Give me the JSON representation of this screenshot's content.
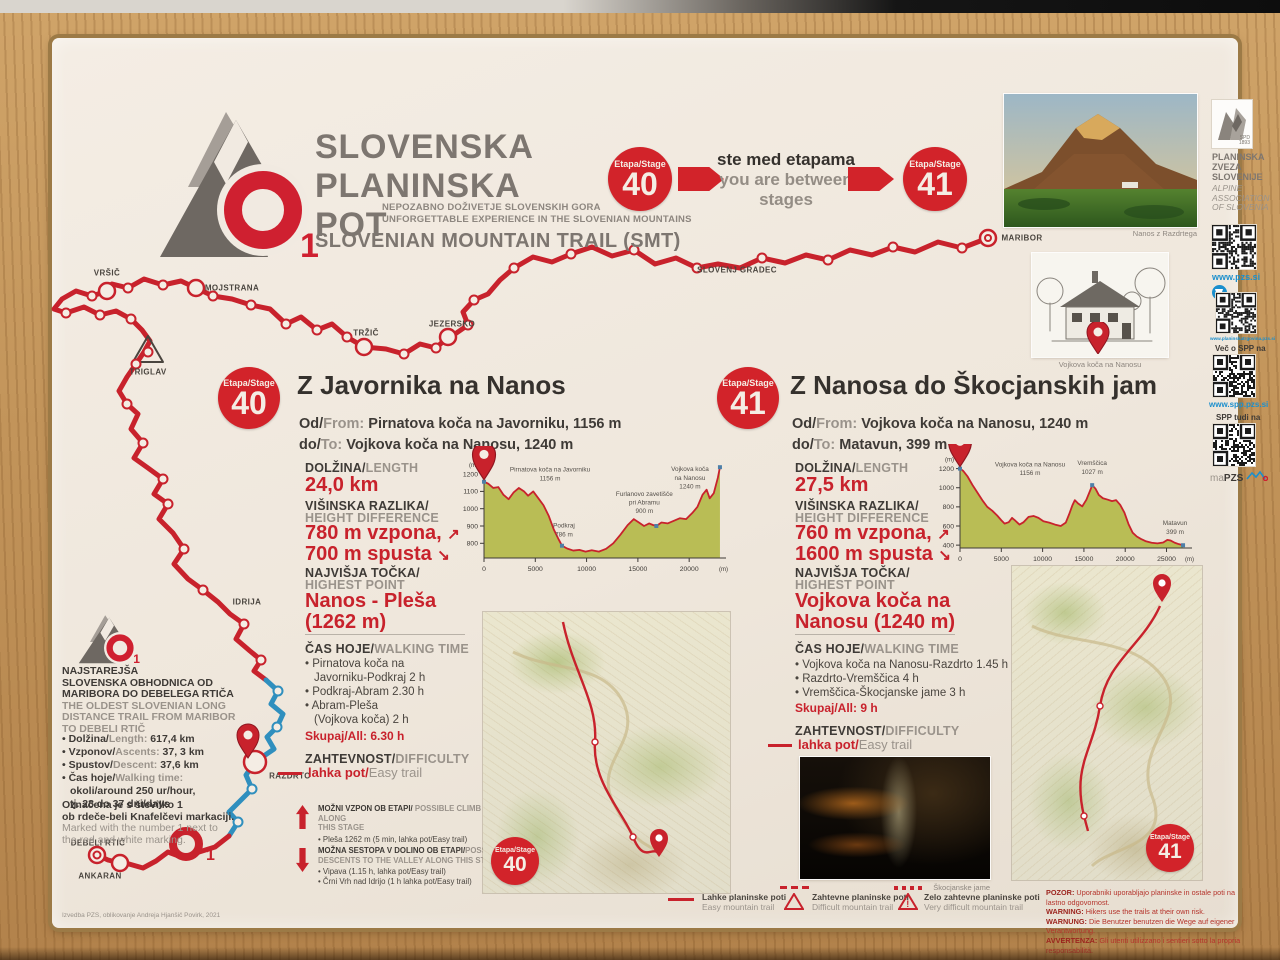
{
  "header": {
    "title_l1": "SLOVENSKA",
    "title_l2": "PLANINSKA",
    "title_l3": "POT",
    "logo_number": "1",
    "sub_sl": "NEPOZABNO DOŽIVETJE SLOVENSKIH GORA",
    "sub_en": "UNFORGETTABLE EXPERIENCE IN THE SLOVENIAN MOUNTAINS",
    "trail_en": "SLOVENIAN MOUNTAIN TRAIL (SMT)",
    "stage_label": "Etapa/Stage",
    "stage_left_num": "40",
    "stage_right_num": "41",
    "between_sl": "ste med etapama",
    "between_en": "you are between stages",
    "photo_caption": "Nanos z Razdrtega",
    "pzs_l1": "PLANINSKA",
    "pzs_l2": "ZVEZA",
    "pzs_l3": "SLOVENIJE",
    "pzs_en_l1": "ALPINE",
    "pzs_en_l2": "ASSOCIATION",
    "pzs_en_l3": "OF SLOVENIA",
    "spd": "SPD",
    "spd_year": "1893"
  },
  "sidebar": {
    "url_pzs": "www.pzs.si",
    "url_shop": "www.planinskatrgovina.pzs.si",
    "more_label": "Več o SPP na",
    "url_spp": "www.spp.pzs.si",
    "also_label": "SPP tudi na",
    "mapzs_ma": "ma",
    "mapzs_pzs": "PZS"
  },
  "map_labels": {
    "vrsic": "VRŠIČ",
    "mojstrana": "MOJSTRANA",
    "triglav": "TRIGLAV",
    "trzic": "TRŽIČ",
    "jezersko": "JEZERSKO",
    "slovenj_gradec": "SLOVENJ GRADEC",
    "maribor": "MARIBOR",
    "idrija": "IDRIJA",
    "razdrto": "RAZDRTO",
    "debeli_rtic": "DEBELI RTIČ",
    "ankaran": "ANKARAN"
  },
  "stage40": {
    "badge_label": "Etapa/Stage",
    "badge_num": "40",
    "title": "Z Javornika na Nanos",
    "od_sl": "Od/",
    "od_en": "From:",
    "od_val": " Pirnatova koča na Javorniku, 1156 m",
    "do_sl": "do/",
    "do_en": "To:",
    "do_val": " Vojkova koča na Nanosu, 1240 m",
    "len_sl": "DOLŽINA/",
    "len_en": "LENGTH",
    "len_val": "24,0 km",
    "hd_sl": "VIŠINSKA RAZLIKA/",
    "hd_en": "HEIGHT DIFFERENCE",
    "hd_up": "780 m vzpona,",
    "hd_down": "700 m spusta",
    "hp_sl": "NAJVIŠJA TOČKA/",
    "hp_en": "HIGHEST POINT",
    "hp_val1": "Nanos - Pleša",
    "hp_val2": "(1262 m)",
    "time_sl": "ČAS HOJE/",
    "time_en": "WALKING TIME",
    "time_lines": [
      "• Pirnatova koča na",
      "Javorniku-Podkraj 2 h",
      "• Podkraj-Abram 2.30 h",
      "• Abram-Pleša",
      "(Vojkova koča) 2 h"
    ],
    "time_total_label": "Skupaj/All:",
    "time_total": " 6.30 h",
    "diff_sl": "ZAHTEVNOST/",
    "diff_en": "DIFFICULTY",
    "diff_val_sl": "lahka pot/",
    "diff_val_en": "Easy trail",
    "climb_sl": "MOŽNI VZPON OB ETAPI/",
    "climb_en": " POSSIBLE CLIMB ALONG",
    "climb_en2": "THIS STAGE",
    "climb_item": "•  Pleša 1262 m (5 min, lahka pot/Easy trail)",
    "desc_sl": "MOŽNA SESTOPA V DOLINO OB ETAPI/",
    "desc_en": "POSSIBLE",
    "desc_en2": "DESCENTS TO THE VALLEY ALONG THIS STAGE",
    "desc_items": [
      "•  Vipava (1.15 h, lahka pot/Easy trail)",
      "•  Črni Vrh nad Idrijo (1 h lahka pot/Easy trail)"
    ]
  },
  "stage41": {
    "badge_label": "Etapa/Stage",
    "badge_num": "41",
    "title": "Z Nanosa do Škocjanskih jam",
    "od_sl": "Od/",
    "od_en": "From:",
    "od_val": " Vojkova koča na Nanosu, 1240 m",
    "do_sl": "do/",
    "do_en": "To:",
    "do_val": " Matavun, 399 m",
    "len_sl": "DOLŽINA/",
    "len_en": "LENGTH",
    "len_val": "27,5 km",
    "hd_sl": "VIŠINSKA RAZLIKA/",
    "hd_en": "HEIGHT DIFFERENCE",
    "hd_up": "760 m vzpona,",
    "hd_down": "1600 m spusta",
    "hp_sl": "NAJVIŠJA TOČKA/",
    "hp_en": "HIGHEST POINT",
    "hp_val1": "Vojkova koča na",
    "hp_val2": "Nanosu (1240 m)",
    "time_sl": "ČAS HOJE/",
    "time_en": "WALKING TIME",
    "time_lines": [
      "• Vojkova koča na Nanosu-Razdrto 1.45 h",
      "• Razdrto-Vremščica 4 h",
      "• Vremščica-Škocjanske jame 3 h"
    ],
    "time_total_label": "Skupaj/All:",
    "time_total": " 9 h",
    "diff_sl": "ZAHTEVNOST/",
    "diff_en": "DIFFICULTY",
    "diff_val_sl": "lahka pot/",
    "diff_val_en": "Easy trail",
    "cave_caption": "Škocjanske jame",
    "hut_caption": "Vojkova koča na Nanosu"
  },
  "trail_info": {
    "sl_lines": [
      "NAJSTAREJŠA",
      "SLOVENSKA OBHODNICA OD",
      "MARIBORA DO DEBELEGA RTIČA"
    ],
    "en_lines": [
      "THE OLDEST SLOVENIAN LONG",
      "DISTANCE TRAIL FROM MARIBOR",
      "TO DEBELI RTIČ"
    ],
    "stats": [
      {
        "sl": "• Dolžina/",
        "en": "Length:",
        "val": " 617,4 km"
      },
      {
        "sl": "• Vzponov/",
        "en": "Ascents:",
        "val": " 37, 3 km"
      },
      {
        "sl": "• Spustov/",
        "en": "Descent:",
        "val": " 37,6 km"
      },
      {
        "sl": "• Čas hoje/",
        "en": "Walking time:",
        "val": ""
      }
    ],
    "time_extra": [
      "okoli/around 250 ur/hour,",
      "tj. 28 do 37 dni/days"
    ],
    "marked_sl": [
      "Označena je s številko 1",
      "ob rdeče-beli Knafelčevi markaciji."
    ],
    "marked_en": [
      "Marked with the number 1 next to",
      "the red and white marking."
    ]
  },
  "legend": {
    "items": [
      {
        "sl": "Lahke planinske poti",
        "en": "Easy mountain trail"
      },
      {
        "sl": "Zahtevne planinske poti",
        "en": "Difficult mountain trail"
      },
      {
        "sl": "Zelo zahtevne planinske poti",
        "en": "Very difficult mountain trail"
      }
    ]
  },
  "warnings": [
    {
      "label": "POZOR:",
      "text": " Uporabniki uporabljajo planinske in ostale poti na lastno odgovornost."
    },
    {
      "label": "WARNING:",
      "text": " Hikers use the trails at their own risk."
    },
    {
      "label": "WARNUNG:",
      "text": " Die Benutzer benutzen die Wege auf eigener Verantwortung."
    },
    {
      "label": "AVVERTENZA:",
      "text": " Gli utenti utilizzano i sentieri sotto la propria responsabilità."
    }
  ],
  "credit": "Izvedba PZS, oblikovanje Andreja Hjanšič Povirk, 2021",
  "colors": {
    "red": "#c8222c",
    "olive": "#b9bd55",
    "blue_link": "#1b8fcd",
    "route_blue": "#2f8fbe"
  },
  "chart_data": [
    {
      "name": "Stage 40 elevation profile",
      "type": "area",
      "xlabel": "distance (m)",
      "ylabel": "elevation (m)",
      "x_unit": "(m)",
      "y_unit": "(m)",
      "xlim": [
        0,
        23200
      ],
      "ylim": [
        715,
        1270
      ],
      "xticks": [
        0,
        5000,
        10000,
        15000,
        20000
      ],
      "yticks": [
        800,
        900,
        1000,
        1100,
        1200
      ],
      "x": [
        0,
        400,
        900,
        1400,
        1900,
        2400,
        2900,
        3400,
        3900,
        4300,
        4800,
        5300,
        5800,
        6300,
        6800,
        7300,
        7600,
        8100,
        8700,
        9300,
        9900,
        10500,
        11200,
        11900,
        12600,
        13300,
        14000,
        14600,
        15100,
        15600,
        16100,
        16500,
        16800,
        17300,
        17900,
        18500,
        19100,
        19700,
        20300,
        20800,
        21300,
        21700,
        22000,
        22400,
        22800,
        23000
      ],
      "y": [
        1156,
        1145,
        1120,
        1125,
        1080,
        1055,
        1095,
        1120,
        1100,
        1075,
        1100,
        1060,
        1020,
        960,
        880,
        820,
        786,
        770,
        758,
        762,
        752,
        760,
        752,
        768,
        800,
        850,
        905,
        940,
        920,
        900,
        915,
        905,
        900,
        920,
        915,
        930,
        945,
        940,
        975,
        1010,
        1080,
        1110,
        1060,
        1090,
        1180,
        1240
      ],
      "annotations": [
        {
          "x": 0,
          "y": 1156,
          "dx": 66,
          "dy": -10,
          "pin": true,
          "lines": [
            "Pirnatova koča na Javorniku",
            "1156 m"
          ]
        },
        {
          "x": 7600,
          "y": 786,
          "dx": 2,
          "dy": -18,
          "lines": [
            "Podkraj",
            "786 m"
          ]
        },
        {
          "x": 16800,
          "y": 900,
          "dx": -12,
          "dy": -30,
          "lines": [
            "Furlanovo zavetišče",
            "pri Abramu",
            "900 m"
          ]
        },
        {
          "x": 23000,
          "y": 1240,
          "dx": -30,
          "dy": 4,
          "lines": [
            "Vojkova koča",
            "na Nanosu",
            "1240 m"
          ]
        }
      ]
    },
    {
      "name": "Stage 41 elevation profile",
      "type": "area",
      "xlabel": "distance (m)",
      "ylabel": "elevation (m)",
      "x_unit": "(m)",
      "y_unit": "(m)",
      "xlim": [
        0,
        27600
      ],
      "ylim": [
        370,
        1290
      ],
      "xticks": [
        0,
        5000,
        10000,
        15000,
        20000,
        25000
      ],
      "yticks": [
        400,
        600,
        800,
        1000,
        1200
      ],
      "x": [
        0,
        400,
        900,
        1500,
        2100,
        2700,
        3300,
        3900,
        4500,
        5000,
        5400,
        5900,
        6300,
        6700,
        7200,
        7700,
        8300,
        8900,
        9500,
        10100,
        10800,
        11500,
        12200,
        12800,
        13200,
        13600,
        13900,
        14300,
        14800,
        15300,
        15800,
        16000,
        16400,
        16800,
        17300,
        17900,
        18400,
        18900,
        19400,
        19900,
        20400,
        20900,
        21400,
        21900,
        22500,
        23200,
        23900,
        24600,
        25100,
        25500,
        26000,
        26500,
        27000
      ],
      "y": [
        1200,
        1175,
        1120,
        1030,
        950,
        870,
        800,
        760,
        710,
        660,
        625,
        640,
        685,
        655,
        615,
        640,
        695,
        705,
        685,
        650,
        635,
        615,
        600,
        635,
        720,
        815,
        870,
        835,
        805,
        875,
        980,
        1027,
        990,
        925,
        890,
        875,
        860,
        870,
        820,
        740,
        620,
        530,
        490,
        465,
        440,
        425,
        418,
        428,
        455,
        448,
        425,
        410,
        399
      ],
      "annotations": [
        {
          "x": 0,
          "y": 1200,
          "dx": 70,
          "dy": -2,
          "pin": true,
          "lines": [
            "Vojkova koča na Nanosu",
            "1156 m"
          ]
        },
        {
          "x": 16000,
          "y": 1027,
          "dx": 0,
          "dy": -20,
          "lines": [
            "Vremščica",
            "1027 m"
          ]
        },
        {
          "x": 27000,
          "y": 399,
          "dx": -8,
          "dy": -20,
          "lines": [
            "Matavun",
            "399 m"
          ]
        }
      ]
    }
  ]
}
